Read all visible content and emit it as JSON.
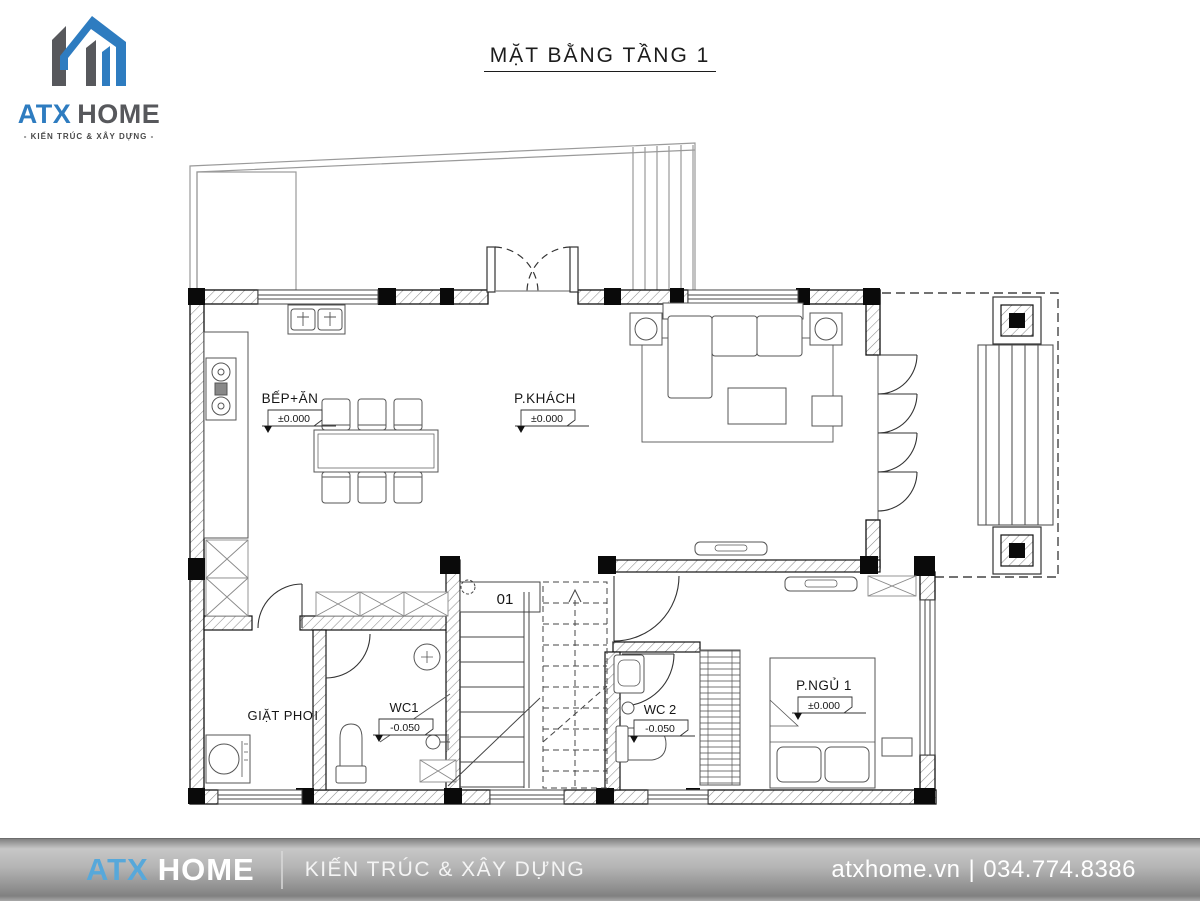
{
  "header": {
    "title": "MẶT BẰNG TẦNG 1"
  },
  "brand": {
    "name_blue": "ATX",
    "name_gray": "HOME",
    "tagline": "- KIẾN TRÚC & XÂY DỰNG -",
    "blue": "#2e7cc0",
    "gray": "#57585c"
  },
  "plan": {
    "stair_label": "01",
    "rooms": [
      {
        "name": "BẾP+ĂN",
        "level": "±0.000"
      },
      {
        "name": "P.KHÁCH",
        "level": "±0.000"
      },
      {
        "name": "GIẶT PHƠI",
        "level": ""
      },
      {
        "name": "WC1",
        "level": "-0.050"
      },
      {
        "name": "WC 2",
        "level": "-0.050"
      },
      {
        "name": "P.NGỦ 1",
        "level": "±0.000"
      }
    ]
  },
  "footer": {
    "brand_blue": "ATX",
    "brand_gray": "HOME",
    "tagline": "KIẾN TRÚC & XÂY DỰNG",
    "website": "atxhome.vn",
    "separator": "|",
    "phone": "034.774.8386",
    "blue": "#57a8da"
  }
}
